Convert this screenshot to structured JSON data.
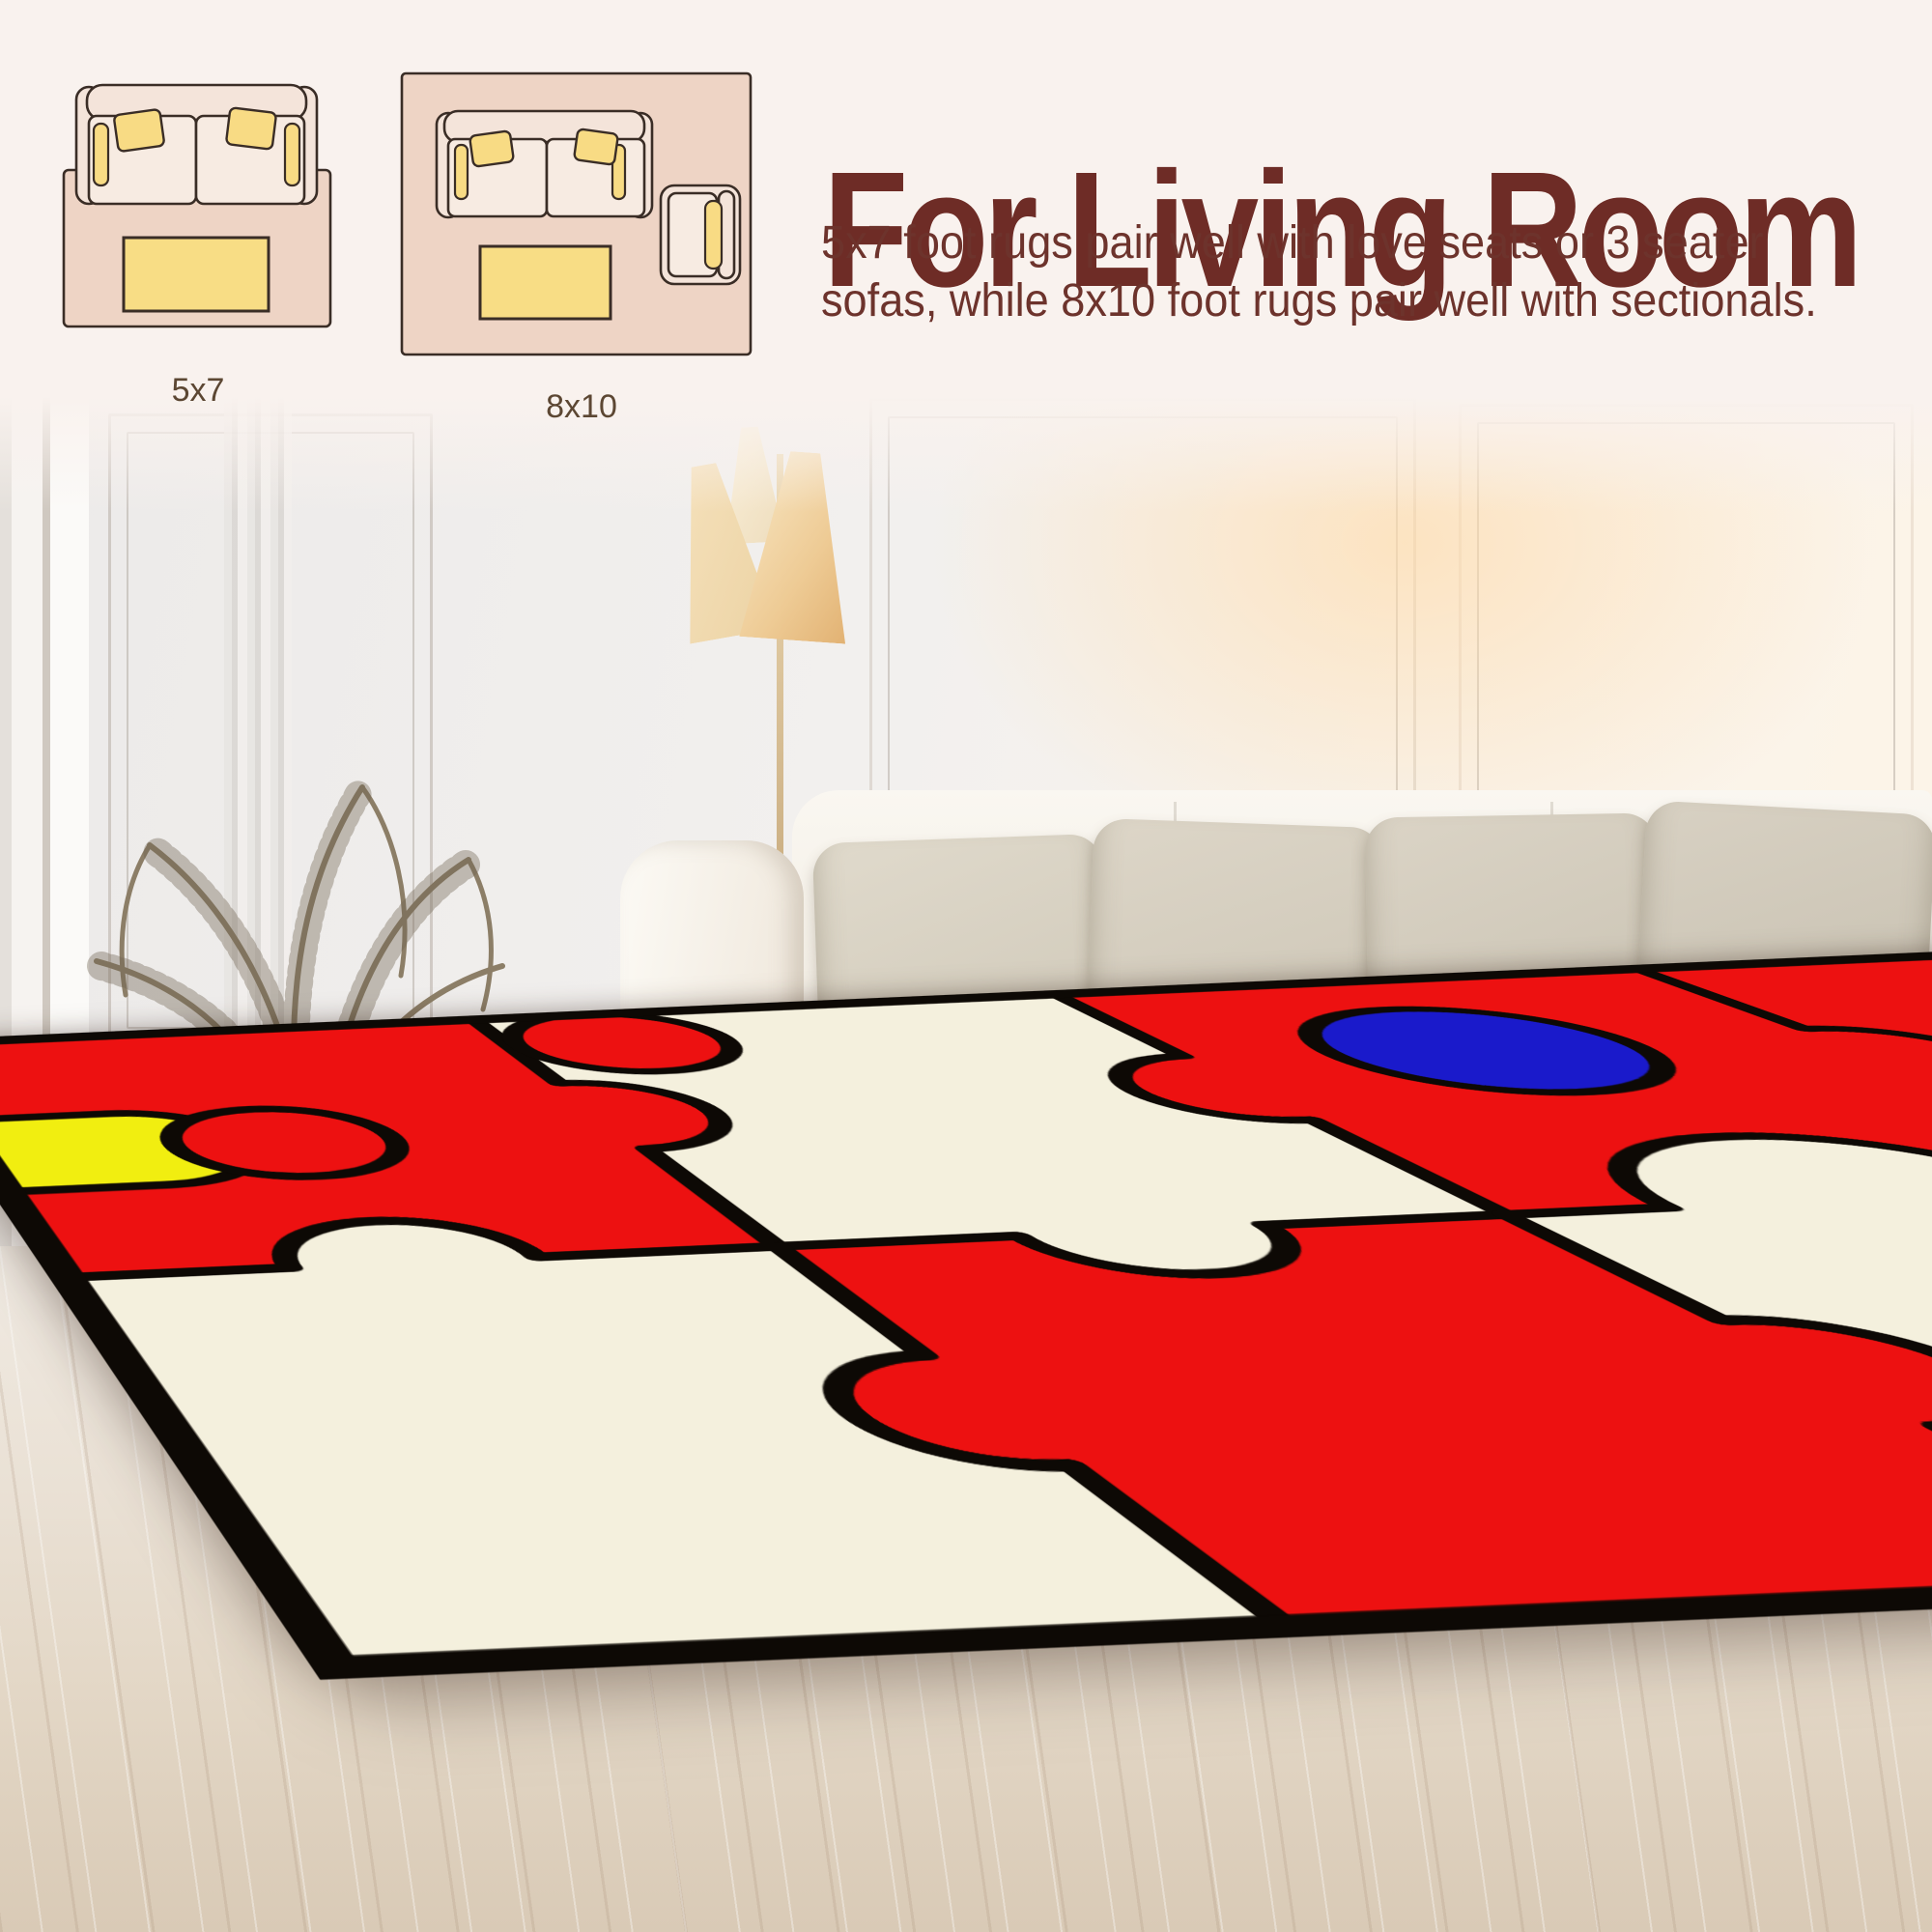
{
  "header": {
    "title": "For Living Room",
    "description_lines": [
      "5x7 foot rugs pair well with love seats or 3 seater",
      "sofas, while 8x10 foot rugs pair well with sectionals."
    ],
    "diagrams": [
      {
        "label": "5x7",
        "items": [
          "loveseat-sofa",
          "area-rug",
          "coffee-table"
        ]
      },
      {
        "label": "8x10",
        "items": [
          "three-seater-sofa",
          "area-rug",
          "coffee-table",
          "armchair"
        ]
      }
    ],
    "colors": {
      "title": "#6e2c26",
      "body_text": "#6d332c",
      "label_text": "#5c4733",
      "background": "#f9f2ee",
      "diagram_rug": "#eed4c5",
      "diagram_furniture": "#f4e4da",
      "diagram_accent_yellow": "#f8db84",
      "diagram_outline": "#3a2d26"
    }
  },
  "scene": {
    "elements": [
      "paneled-wall",
      "floor-lamp",
      "dried-palm-plant",
      "terracotta-pot",
      "book-stack",
      "leaning-frames",
      "white-sofa",
      "throw-pillows",
      "whitewashed-wood-floor",
      "puzzle-area-rug"
    ],
    "rug": {
      "style": "jigsaw-puzzle",
      "colors": {
        "field": "#ed1111",
        "pieces": "#f4f0dd",
        "accent_blue": "#1a1acb",
        "accent_yellow": "#f1ee10",
        "outline": "#0d0905"
      }
    }
  }
}
